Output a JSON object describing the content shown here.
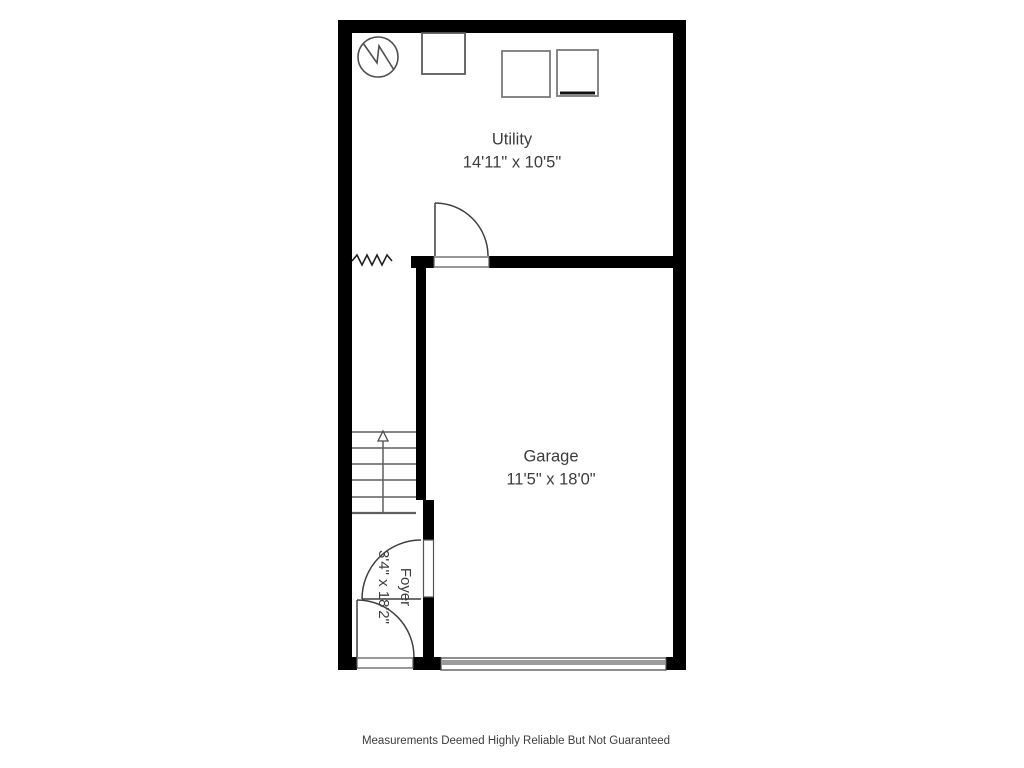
{
  "page": {
    "background": "#ffffff"
  },
  "floorplan": {
    "rooms": [
      {
        "id": "utility",
        "name": "Utility",
        "dimensions": "14'11\" x 10'5\""
      },
      {
        "id": "garage",
        "name": "Garage",
        "dimensions": "11'5\" x 18'0\""
      },
      {
        "id": "foyer",
        "name": "Foyer",
        "dimensions": "3'4\" x 18'2\""
      }
    ],
    "symbols": [
      "water-heater-icon",
      "appliance-icon",
      "washer-icon",
      "dryer-icon",
      "stairs-up-arrow-icon",
      "door-swing-icon",
      "garage-door-icon",
      "break-line-icon"
    ],
    "colors": {
      "wall": "#000000",
      "thin_line": "#3f3f3f",
      "stair_line": "#5f5f5f",
      "appliance_border": "#757575",
      "garage_door_fill": "#9b9b9b",
      "text": "#3d3d3d",
      "background": "#ffffff"
    }
  },
  "footer": {
    "disclaimer": "Measurements Deemed Highly Reliable But Not Guaranteed"
  }
}
